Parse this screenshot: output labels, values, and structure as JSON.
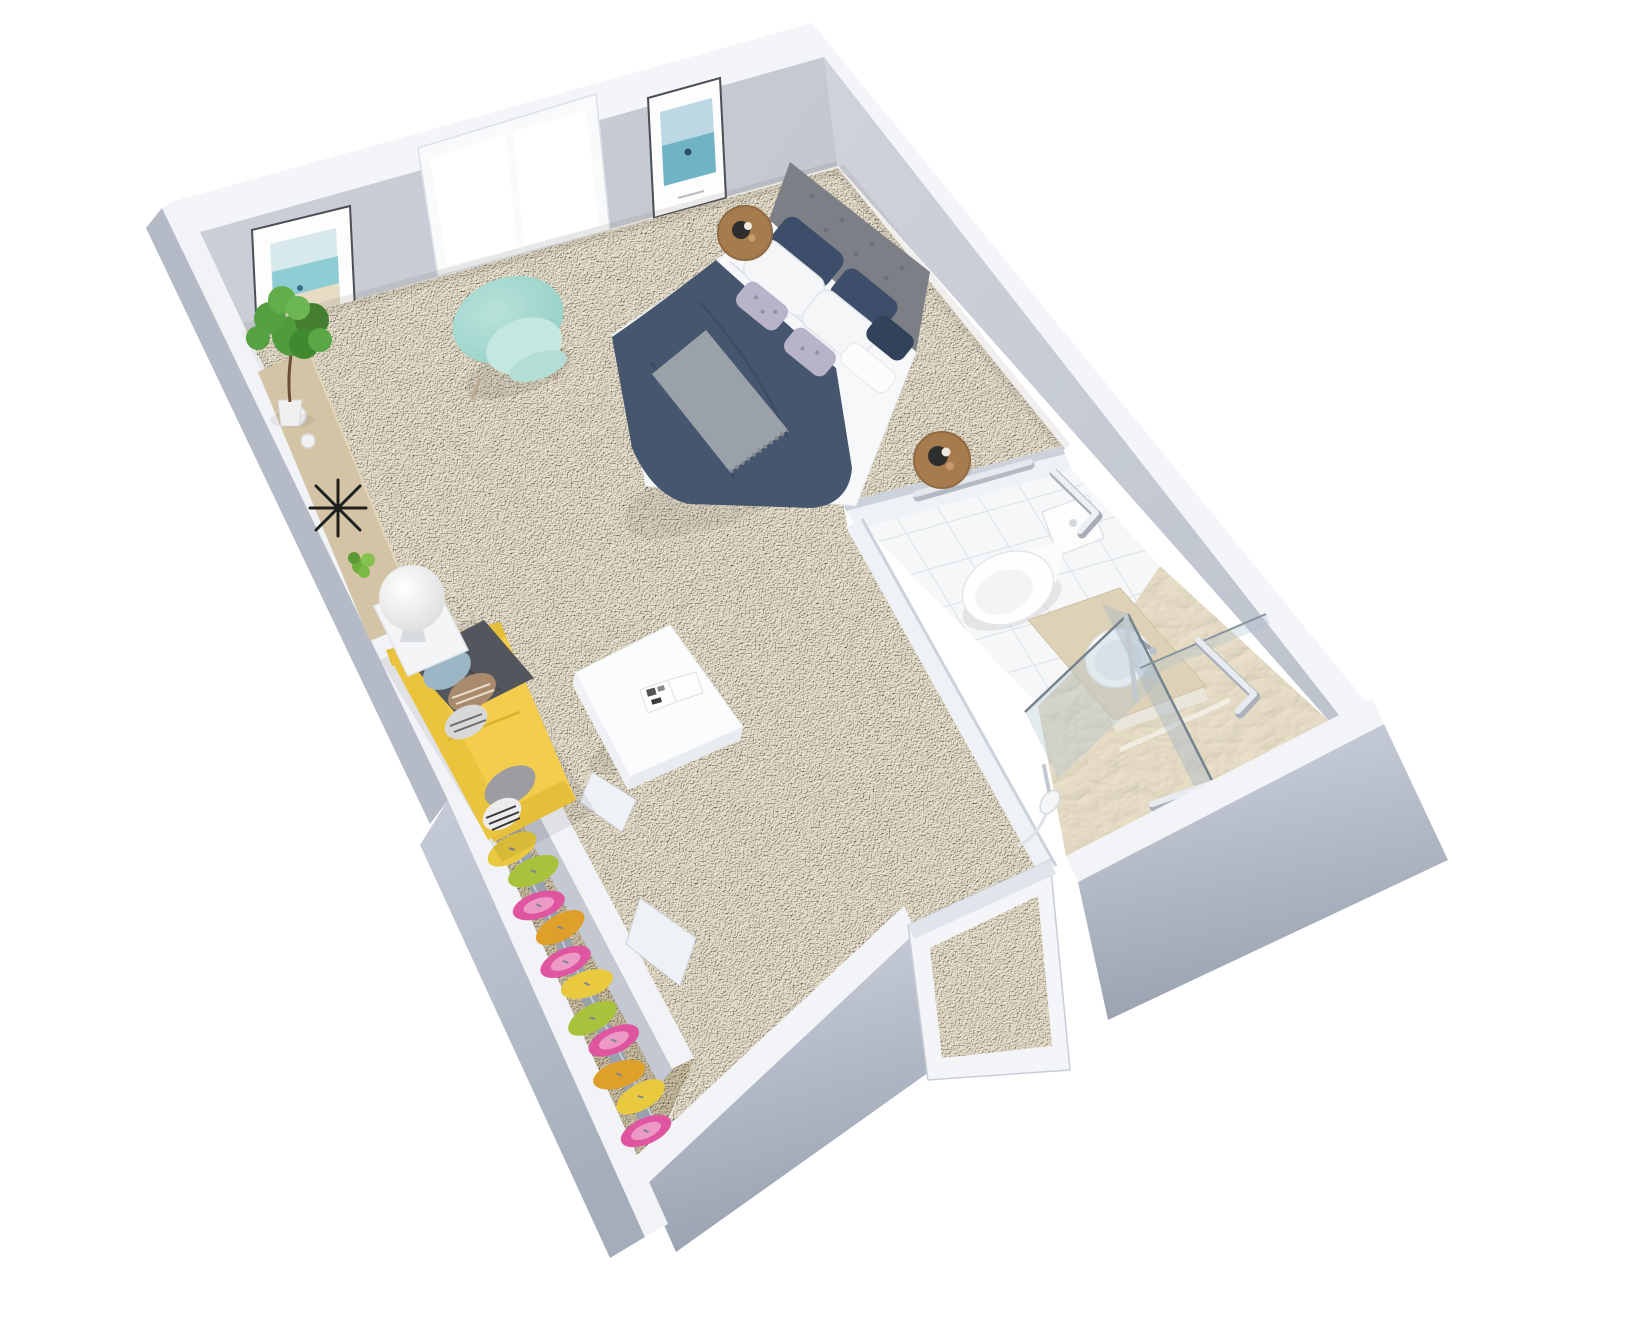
{
  "meta": {
    "type": "3d-floorplan-render",
    "description": "Isometric 3D rendering of a furnished studio apartment viewed from above: bedroom and living area with beige carpet, walk-in closet with colorful garments, and an accessible bathroom with toilet, vanity, glass shower and grab bars, on a plain white background.",
    "background_color": "#ffffff",
    "text_visible": "none"
  },
  "rooms": [
    {
      "id": "bedroom-living",
      "label": "Bedroom / living area",
      "flooring": "beige carpet",
      "items": [
        "double bed with navy blue duvet, white sheets, navy and patterned pillows",
        "gray upholstered headboard",
        "two round wooden side tables with small trays",
        "mint-green armchair under the window",
        "yellow sofa with blue-gray, checkered and striped accent pillows and dark gray throw",
        "white square coffee table with open magazine",
        "light wood console shelf along the wall",
        "black starburst wall clock on console",
        "white ceramic vases",
        "small potted plant on console",
        "tall potted fig plant in corner",
        "white sphere floor lamp on white side table",
        "double sliding window",
        "two framed seascape art prints"
      ]
    },
    {
      "id": "closet",
      "label": "Walk-in closet",
      "flooring": "dark beige carpet",
      "items": [
        "hanging rail with colorful garments"
      ]
    },
    {
      "id": "bathroom",
      "label": "Accessible bathroom",
      "flooring": "white tile with travertine shower floor",
      "items": [
        "toilet with tank",
        "vanity with beige stone counter and round white basin with chrome faucet",
        "frameless glass shower screens with chrome post",
        "handheld shower head",
        "multiple safety grab bars on walls"
      ]
    },
    {
      "id": "entry",
      "label": "Entry",
      "items": [
        "open white door frame in the lower wall"
      ]
    }
  ],
  "closet": {
    "garments": [
      {
        "color": "#e9c93e",
        "patterned": false
      },
      {
        "color": "#a9c23c",
        "patterned": false
      },
      {
        "color": "#e055a0",
        "patterned": true
      },
      {
        "color": "#df9f2b",
        "patterned": false
      },
      {
        "color": "#e055a0",
        "patterned": true
      },
      {
        "color": "#e9c93e",
        "patterned": false
      },
      {
        "color": "#a9c23c",
        "patterned": false
      },
      {
        "color": "#e055a0",
        "patterned": true
      },
      {
        "color": "#df9f2b",
        "patterned": false
      },
      {
        "color": "#e9c93e",
        "patterned": false
      },
      {
        "color": "#e055a0",
        "patterned": true
      }
    ],
    "rail": {
      "x1": 516,
      "y1": 846,
      "x2": 650,
      "y2": 1128
    }
  },
  "palette": {
    "wall_face": "#c7cbd3",
    "wall_cap": "#f2f4f8",
    "wall_exterior_dark": "#9ea6b4",
    "carpet": "#e9dfc6",
    "closet_carpet": "#c9bda2",
    "tile": "#f5f7f8",
    "shower_floor": "#e5dcc5",
    "duvet_navy": "#46566f",
    "sofa_yellow": "#f3cd4b",
    "armchair_mint": "#a8d9d0",
    "wood": "#a67c4f",
    "console_wood": "#d3c4a5",
    "plant_green": "#4f9a3c",
    "glass": "#aabccb",
    "chrome": "#c2c9d1"
  }
}
